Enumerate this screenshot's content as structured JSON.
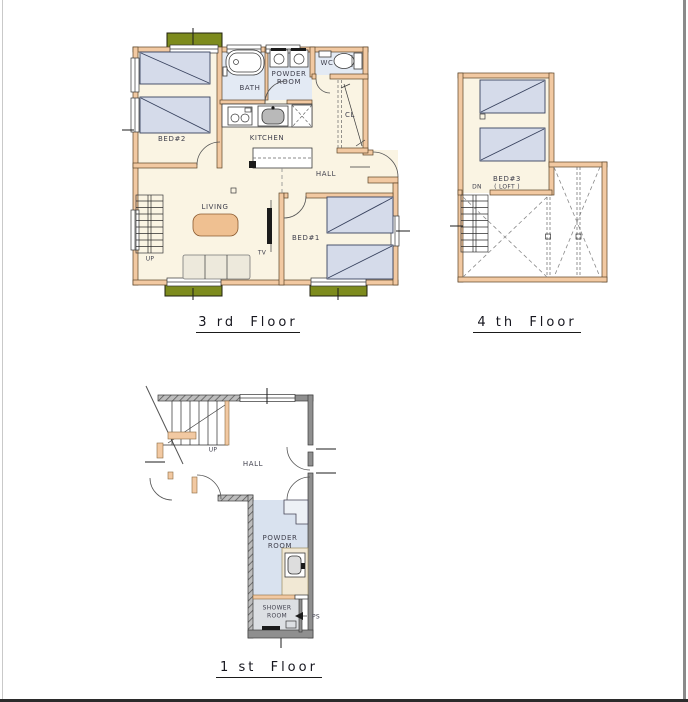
{
  "document": {
    "type": "architectural-floor-plan-sheet",
    "floor_count": 3
  },
  "colors": {
    "wall_fill": "#F2C9A2",
    "wall_outline": "#5C4327",
    "floor_cream": "#FAF4E3",
    "wet_area_blue": "#E3EAF4",
    "bed_fill": "#D5DBEA",
    "balcony_green": "#7D8B1D",
    "first_floor_wall_gray": "#8F8F8F",
    "powder_floor_blue": "#D9E2EF",
    "counter_cream": "#F1E8D4",
    "table_fill": "#EFC091",
    "sofa_fill": "#EDE9DC",
    "label_color": "#41414E",
    "title_color": "#16161E"
  },
  "floors": {
    "third": {
      "title": "3 rd  Floor",
      "labels": {
        "bed2": "BED#2",
        "bath": "BATH",
        "powder1": "POWDER",
        "powder2": "ROOM",
        "wc": "WC",
        "cl": "CL",
        "kitchen": "KITCHEN",
        "hall": "HALL",
        "living": "LIVING",
        "tv": "TV",
        "bed1": "BED#1",
        "up": "UP"
      }
    },
    "fourth": {
      "title": "4 th  Floor",
      "labels": {
        "bed3": "BED#3",
        "loft": "( LOFT )",
        "dn": "DN"
      }
    },
    "first": {
      "title": "1 st  Floor",
      "labels": {
        "up": "UP",
        "hall": "HALL",
        "powder1": "POWDER",
        "powder2": "ROOM",
        "shower1": "SHOWER",
        "shower2": "ROOM",
        "ps": "PS"
      }
    }
  }
}
